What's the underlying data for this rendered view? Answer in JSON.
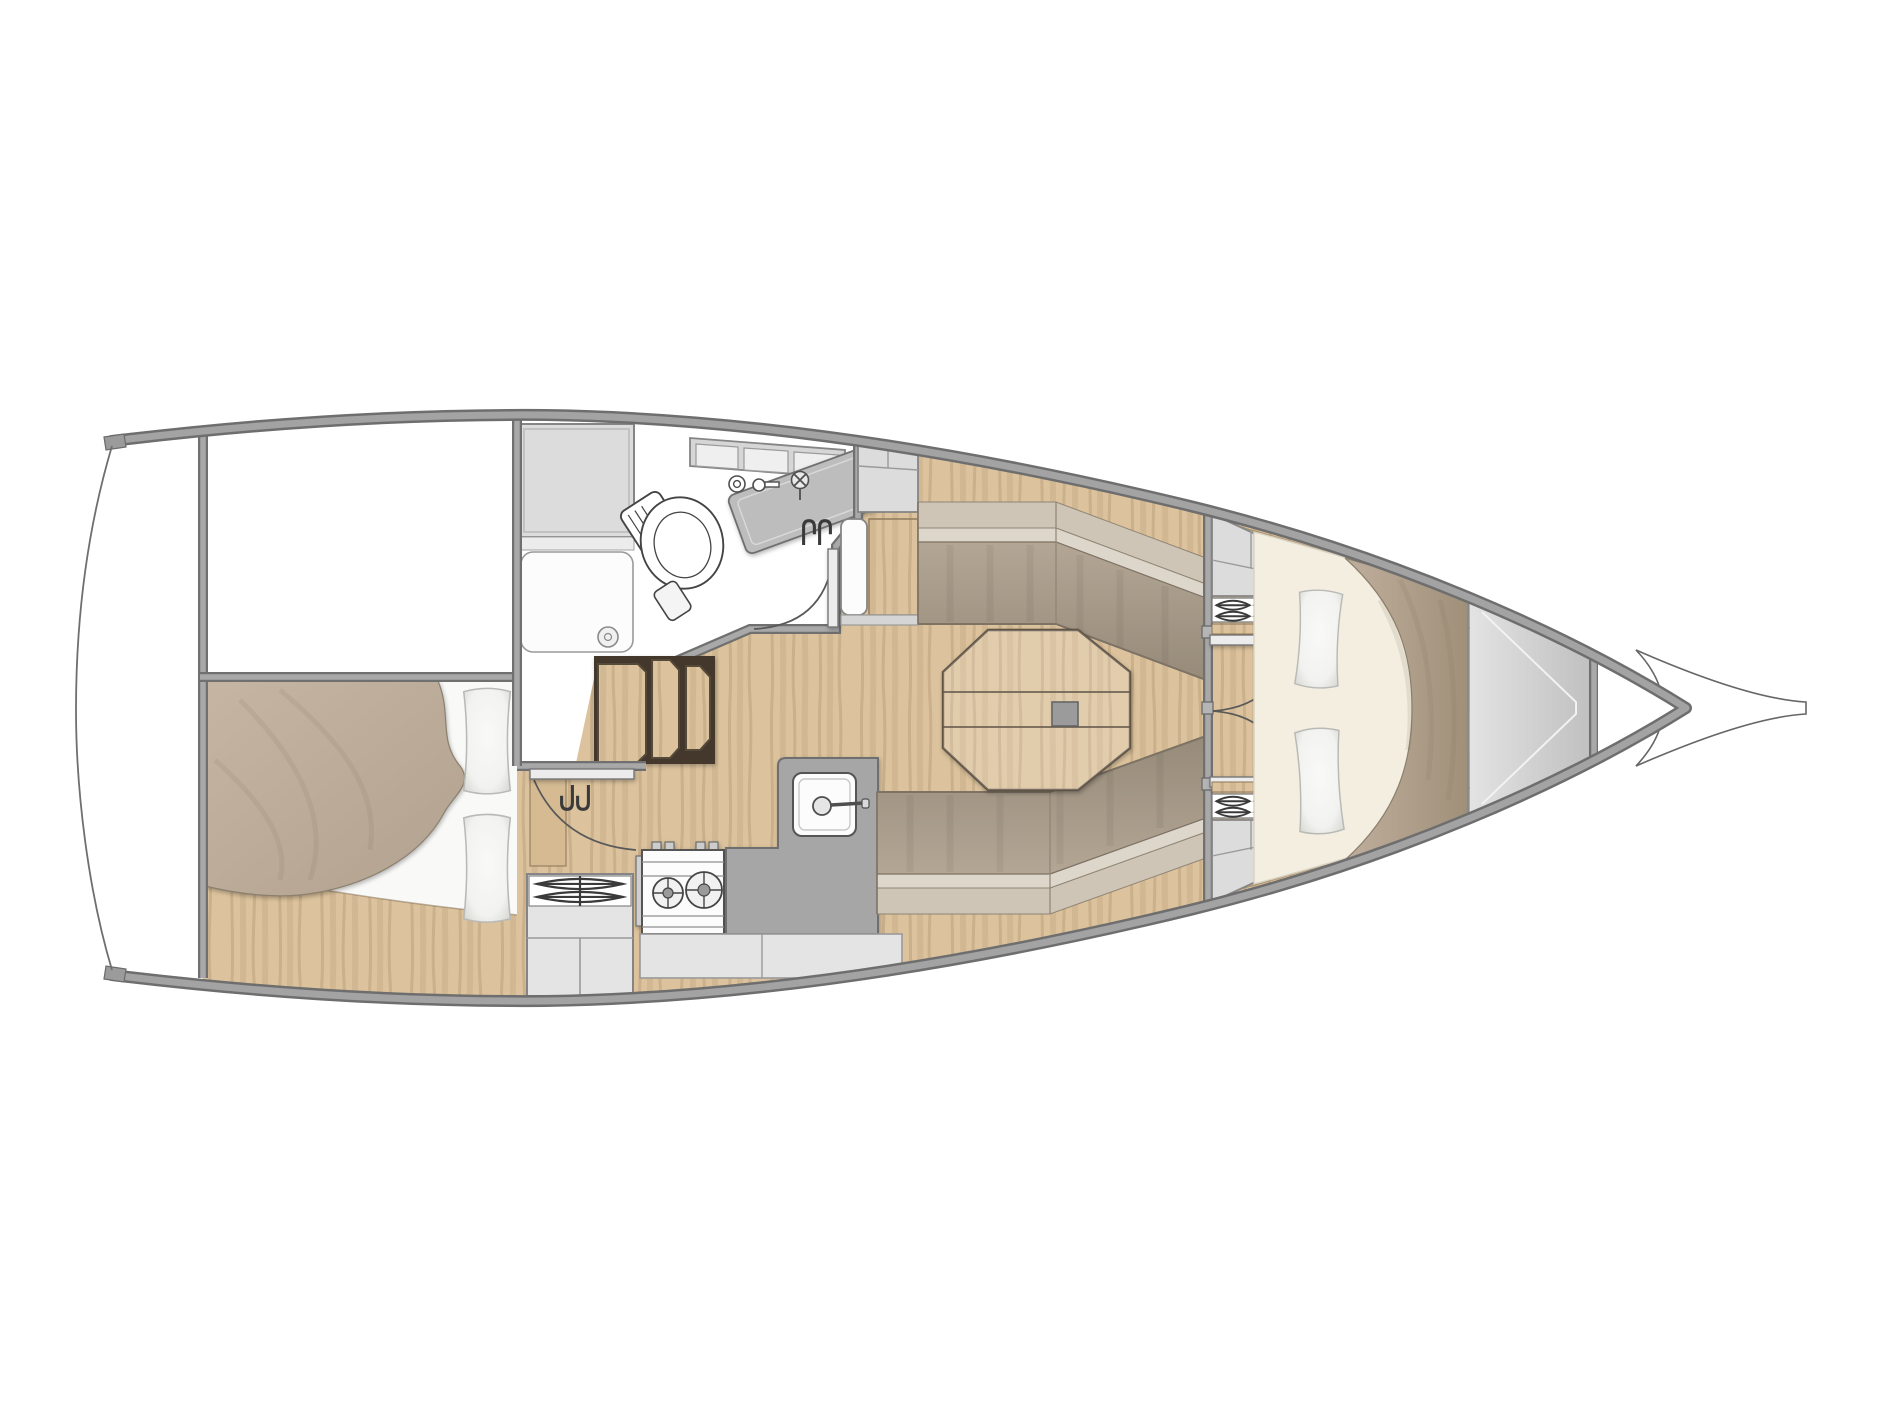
{
  "document": {
    "type": "sailboat-interior-floor-plan",
    "view": "top-down",
    "orientation": "bow-right-stern-left"
  },
  "canvas": {
    "width": 1900,
    "height": 1425,
    "background": "#ffffff"
  },
  "colors": {
    "hull_fill": "#ffffff",
    "hull_edge": "#6e6e6e",
    "hull_band": "#a3a3a3",
    "transom_line": "#6f6f6f",
    "wood_base": "#dcc39d",
    "wood_grain": "#8a6f48",
    "wood_step_strip": "#d5ba92",
    "table_wood": "#e4cda6",
    "table_outline": "#5f5346",
    "table_hatch_square": "#9b9b9b",
    "cushion_light": "#cfc5b7",
    "cushion_seam_band": "#ddd6ca",
    "cushion_face_a": "#b3a695",
    "cushion_face_b": "#968a79",
    "cushion_outline": "#7d7264",
    "blanket_aft_a": "#c6b5a3",
    "blanket_aft_b": "#b2a18f",
    "blanket_fwd_a": "#bfae9c",
    "blanket_fwd_b": "#a09079",
    "blanket_outline": "#8b7f6e",
    "linen_white": "#f9f9f7",
    "linen_shade": "#d8d8d4",
    "sheet_cream": "#f3eee0",
    "cabinet_fill": "#dcdcdc",
    "cabinet_stroke": "#858585",
    "cabinet_inner": "#f1f1f1",
    "counter_dark": "#a6a6a6",
    "counter_dark_stroke": "#6f6f6f",
    "counter_light": "#e4e4e4",
    "fixture_white": "#fcfcfc",
    "fixture_stroke": "#4f4f4f",
    "bow_locker_a": "#e3e3e3",
    "bow_locker_b": "#bfbfbf",
    "step_riser": "#43382b"
  },
  "features": [
    {
      "id": "hull-outline"
    },
    {
      "id": "bowsprit"
    },
    {
      "id": "transom"
    },
    {
      "id": "cockpit-well"
    },
    {
      "id": "aft-cabin-berth"
    },
    {
      "id": "aft-cabin-pillows"
    },
    {
      "id": "head-compartment"
    },
    {
      "id": "shower-pan"
    },
    {
      "id": "marine-toilet"
    },
    {
      "id": "head-sink"
    },
    {
      "id": "head-shelf"
    },
    {
      "id": "head-door"
    },
    {
      "id": "companionway-steps"
    },
    {
      "id": "aft-cabin-door"
    },
    {
      "id": "galley-stove"
    },
    {
      "id": "galley-sink"
    },
    {
      "id": "galley-counters"
    },
    {
      "id": "galley-vent-locker"
    },
    {
      "id": "refrigerator"
    },
    {
      "id": "saloon-table"
    },
    {
      "id": "port-settee"
    },
    {
      "id": "starboard-settee"
    },
    {
      "id": "forward-bulkhead-doors"
    },
    {
      "id": "forward-lockers"
    },
    {
      "id": "v-berth"
    },
    {
      "id": "v-berth-pillows"
    },
    {
      "id": "anchor-locker"
    }
  ]
}
